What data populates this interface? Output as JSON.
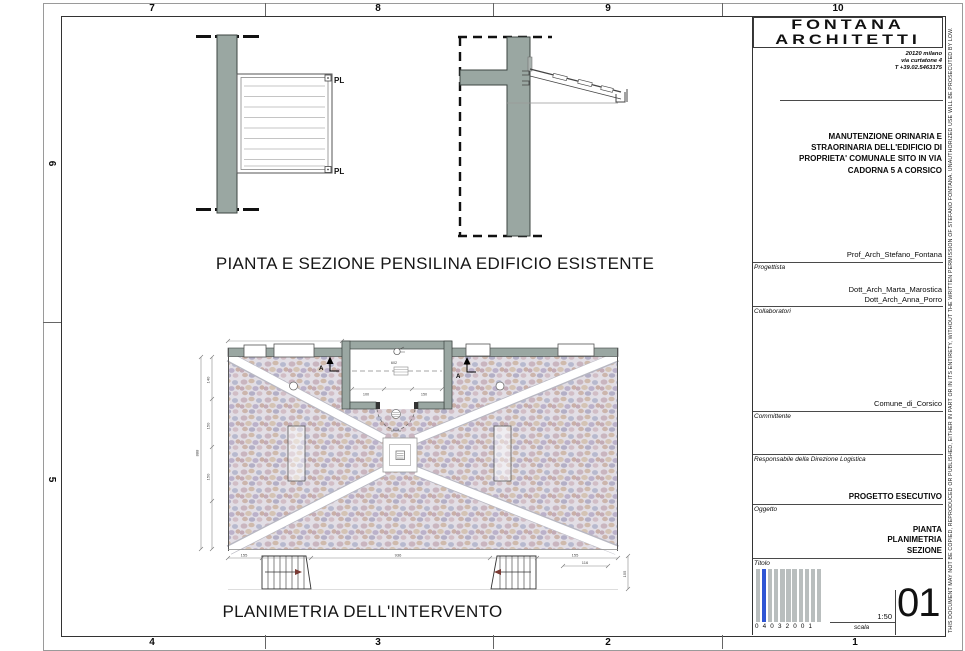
{
  "sheet": {
    "grid": {
      "top": [
        "7",
        "8",
        "9",
        "10"
      ],
      "bottom": [
        "4",
        "3",
        "2",
        "1"
      ],
      "left": [
        "6",
        "5"
      ]
    },
    "disclaimer": "THIS DOCUMENT MAY NOT BE COPIED, REPRODUCED OR PUBLISHED, EITHER IN PART OR IN ITS ENTIRETY, WITHOUT THE WRITTEN PERMISSION OF STEFANO FONTANA. UNAUTHORIZED USE WILL BE PROSECUTED BY LOW."
  },
  "titleblock": {
    "firm_name_line1": "FONTANA",
    "firm_name_line2": "ARCHITETTI",
    "address_line1": "20120 milano",
    "address_line2": "via curtatone 4",
    "address_line3": "T +39.02.5463175",
    "project_line1": "MANUTENZIONE ORINARIA E",
    "project_line2": "STRAORINARIA DELL'EDIFICIO DI",
    "project_line3": "PROPRIETA' COMUNALE SITO IN VIA",
    "project_line4": "CADORNA 5 A CORSICO",
    "progettista_label": "Progettista",
    "progettista_value": "Prof_Arch_Stefano_Fontana",
    "collaboratori_label": "Collaboratori",
    "collaboratori_value1": "Dott_Arch_Marta_Marostica",
    "collaboratori_value2": "Dott_Arch_Anna_Porro",
    "committente_label": "Committente",
    "committente_value": "Comune_di_Corsico",
    "responsabile_label": "Responsabile della Direzione Logistica",
    "oggetto_label": "Oggetto",
    "oggetto_value": "PROGETTO ESECUTIVO",
    "titolo_label": "Titolo",
    "titolo_value1": "PIANTA",
    "titolo_value2": "PLANIMETRIA",
    "titolo_value3": "SEZIONE",
    "barcode_digits": "0 4 0 3 2 0 0 1",
    "scala_label": "scala",
    "scala_value": "1:50",
    "sheet_number": "01"
  },
  "drawings": {
    "caption_top": "PIANTA E SEZIONE PENSILINA EDIFICIO ESISTENTE",
    "caption_bottom": "PLANIMETRIA DELL'INTERVENTO",
    "pl_label_top": "PL",
    "pl_label_bottom": "PL",
    "section_marker": "A",
    "dims": {
      "left_total": "888",
      "left_1": "140",
      "left_2": "150",
      "left_3": "150",
      "bottom_1": "155",
      "bottom_2": "936",
      "bottom_3": "155",
      "right_1": "116",
      "right_2": "155",
      "room_1": "602",
      "room_2": "100",
      "room_3": "150"
    }
  },
  "colors": {
    "wall_gray": "#9aa7a2",
    "barcode_gray": "#b9bebe",
    "barcode_blue": "#2f55d4",
    "paving_base": "#e2dee5"
  }
}
